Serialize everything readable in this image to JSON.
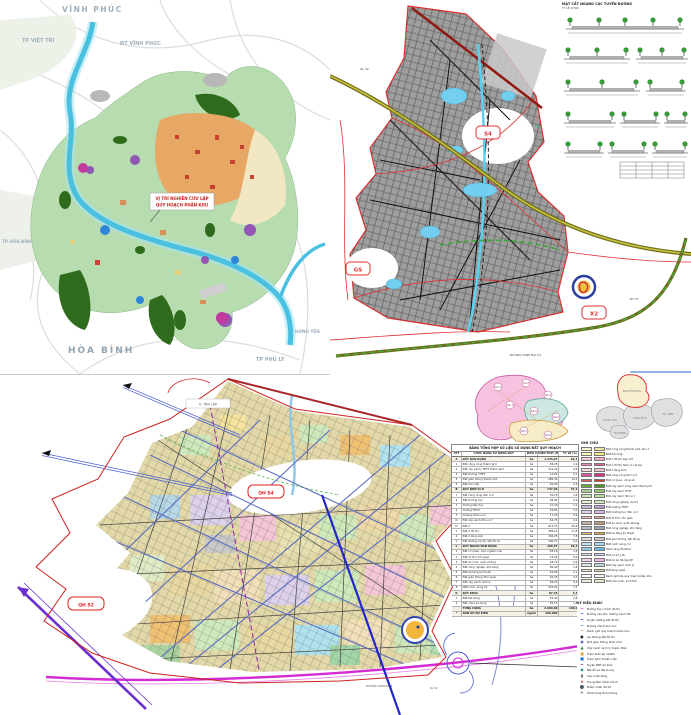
{
  "regional_map": {
    "labels": {
      "vinh_phuc": "VĨNH PHÚC",
      "dt_vinh_phuc": "ĐT VĨNH PHÚC",
      "tp_viet_tri": "TP VIỆT TRÌ",
      "tp_hoa_binh": "TP HÒA BÌNH",
      "hoa_binh": "HÒA BÌNH",
      "tp_phu_ly": "TP PHỦ LÝ",
      "hung_yen": "HƯNG YÊN"
    },
    "callout_line1": "VỊ TRÍ NGHIÊN CỨU LẬP",
    "callout_line2": "QUY HOẠCH PHÂN KHU"
  },
  "district_map": {
    "zone_labels": {
      "s4": "S4",
      "gs": "GS",
      "x2": "X2"
    },
    "road_labels": {
      "a": "QL 32",
      "b": "ĐƯỜNG VÀNH ĐAI 3,5",
      "c": "ĐT 70"
    },
    "sections_panel": {
      "title": "MẶT CẮT NGANG CÁC TUYẾN ĐƯỜNG",
      "subtitle": "TỶ LỆ 1/500"
    }
  },
  "zoning_map": {
    "zone_labels": {
      "qh_s2": "QH S2",
      "qh_s4": "QH S4"
    },
    "area_box": "X. TÂN LẬP",
    "road_labels": {
      "a": "ĐƯỜNG VÀNH ĐAI 4",
      "b": "QL 32"
    }
  },
  "panel": {
    "inset_pink_labels": [
      "S1-1",
      "S1-2",
      "S1-3",
      "S2-1",
      "S2-2",
      "S2-3",
      "S3-1",
      "S3-2"
    ],
    "inset_gray_labels": [
      "QUỐC OAI",
      "HOÀI ĐỨC",
      "TỪ LIÊM",
      "ĐAN PHƯỢNG",
      "HÀ ĐÔNG"
    ],
    "table": {
      "title": "BẢNG TỔNG HỢP SỐ LIỆU SỬ DỤNG ĐẤT QUY HOẠCH",
      "headers": [
        "STT",
        "CHỨC NĂNG SỬ DỤNG ĐẤT",
        "ĐƠN VỊ",
        "DIỆN TÍCH (HA)",
        "TỶ LỆ (%)"
      ],
      "rows": [
        [
          "A",
          "ĐẤT DÂN DỤNG",
          "ha",
          "1.245,67",
          "62,3"
        ],
        [
          "1",
          "Đất công cộng thành phố",
          "ha",
          "38,25",
          "1,9"
        ],
        [
          "2",
          "Đất cây xanh, TDTT thành phố",
          "ha",
          "112,40",
          "5,6"
        ],
        [
          "3",
          "Đất trường THPT",
          "ha",
          "14,82",
          "0,7"
        ],
        [
          "4",
          "Đất giao thông thành phố",
          "ha",
          "286,34",
          "14,3"
        ],
        [
          "5",
          "Đất hỗn hợp",
          "ha",
          "46,90",
          "2,3"
        ],
        [
          "B",
          "ĐẤT ĐƠN VỊ Ở",
          "ha",
          "747,96",
          "37,4"
        ],
        [
          "I",
          "Đất công cộng đơn vị ở",
          "ha",
          "32,15",
          "1,6"
        ],
        [
          "II",
          "Đất trường học",
          "ha",
          "58,44",
          "2,9"
        ],
        [
          "1",
          "Trường tiểu học",
          "ha",
          "21,30",
          "1,1"
        ],
        [
          "2",
          "Trường THCS",
          "ha",
          "19,85",
          "1,0"
        ],
        [
          "3",
          "Trường mầm non",
          "ha",
          "17,29",
          "0,9"
        ],
        [
          "III",
          "Đất cây xanh đơn vị ở",
          "ha",
          "44,73",
          "2,2"
        ],
        [
          "IV",
          "Đất ở",
          "ha",
          "512,37",
          "25,6"
        ],
        [
          "1",
          "Đất ở đô thị",
          "ha",
          "356,12",
          "17,8"
        ],
        [
          "2",
          "Đất ở làng xóm",
          "ha",
          "156,25",
          "7,8"
        ],
        [
          "V",
          "Đất đường nội bộ, bãi đỗ xe",
          "ha",
          "100,27",
          "5,0"
        ],
        [
          "C",
          "ĐẤT NGOÀI DÂN DỤNG",
          "ha",
          "406,37",
          "20,3"
        ],
        [
          "1",
          "Đất cơ quan, viện nghiên cứu",
          "ha",
          "28,16",
          "1,4"
        ],
        [
          "2",
          "Đất di tích, tôn giáo",
          "ha",
          "12,44",
          "0,6"
        ],
        [
          "3",
          "Đất an ninh, quốc phòng",
          "ha",
          "18,72",
          "0,9"
        ],
        [
          "4",
          "Đất công nghiệp, kho tàng",
          "ha",
          "36,90",
          "1,8"
        ],
        [
          "5",
          "Đất hạ tầng kỹ thuật",
          "ha",
          "22,58",
          "1,1"
        ],
        [
          "6",
          "Đất giao thông đối ngoại",
          "ha",
          "94,35",
          "4,7"
        ],
        [
          "7",
          "Đất cây xanh cách ly",
          "ha",
          "48,20",
          "2,4"
        ],
        [
          "8",
          "Mặt nước, sông hồ",
          "ha",
          "145,02",
          "7,3"
        ],
        [
          "D",
          "ĐẤT KHÁC",
          "ha",
          "87,45",
          "4,4"
        ],
        [
          "1",
          "Đất bãi sông",
          "ha",
          "52,30",
          "2,6"
        ],
        [
          "2",
          "Đất chưa sử dụng",
          "ha",
          "35,15",
          "1,8"
        ],
        [
          "",
          "TỔNG CỘNG",
          "ha",
          "2.000,00",
          "100,0"
        ],
        [
          "*",
          "DÂN SỐ DỰ KIẾN",
          "người",
          "160.000",
          ""
        ]
      ]
    },
    "legend": {
      "title": "GHI CHÚ",
      "items": [
        {
          "c1": "#f5eecb",
          "c2": "#efe3a6",
          "label": "Đất công cộng thành phố, khu ở"
        },
        {
          "c1": "#fdf3b0",
          "c2": "#f9e97e",
          "label": "Đất hỗn hợp"
        },
        {
          "c1": "#f8cadd",
          "c2": "#f3aacb",
          "label": "Đất ở đô thị xây mới"
        },
        {
          "c1": "#f086b8",
          "c2": "#e55f9f",
          "label": "Đất ở đô thị hiện có cải tạo"
        },
        {
          "c1": "#f6dade",
          "c2": "#f0c4cc",
          "label": "Đất ở làng xóm"
        },
        {
          "c1": "#e0559f",
          "c2": "#d63384",
          "label": "Đất công cộng đơn vị ở"
        },
        {
          "c1": "#dd5a50",
          "c2": "#cb3a30",
          "label": "Đất cơ quan, công sở"
        },
        {
          "c1": "#6aab3c",
          "c2": "#55942c",
          "label": "Đất cây xanh công viên thành phố"
        },
        {
          "c1": "#a9d18e",
          "c2": "#92c272",
          "label": "Đất cây xanh TDTT"
        },
        {
          "c1": "#cbe8ba",
          "c2": "#b6dda2",
          "label": "Đất cây xanh đơn vị ở"
        },
        {
          "c1": "#e1f0d1",
          "c2": "#d2e8bf",
          "label": "Đất nông nghiệp, dự trữ"
        },
        {
          "c1": "#cdb5dd",
          "c2": "#bb9ad0",
          "label": "Đất trường THPT"
        },
        {
          "c1": "#e3cfee",
          "c2": "#d5b8e6",
          "label": "Đất trường học đơn vị ở"
        },
        {
          "c1": "#f1bab4",
          "c2": "#e9a098",
          "label": "Đất di tích, tôn giáo"
        },
        {
          "c1": "#c8b39a",
          "c2": "#b69d80",
          "label": "Đất an ninh, quốc phòng"
        },
        {
          "c1": "#b7bec7",
          "c2": "#9ca5b1",
          "label": "Đất công nghiệp, kho tàng"
        },
        {
          "c1": "#ecc05a",
          "c2": "#e2ad38",
          "label": "Đất hạ tầng kỹ thuật"
        },
        {
          "c1": "#dddddd",
          "c2": "#c6c6c6",
          "label": "Đất giao thông, bãi đỗ xe"
        },
        {
          "c1": "#c2e5f6",
          "c2": "#a2d7f1",
          "label": "Mặt nước sông, hồ"
        },
        {
          "c1": "#90cbe7",
          "c2": "#6dbade",
          "label": "Hành lang thoát lũ"
        },
        {
          "c1": "#e7e1f9",
          "c2": "#d6cef3",
          "label": "Đất cơ sở y tế"
        },
        {
          "c1": "#f4d2f5",
          "c2": "#ebb5ed",
          "label": "Đất dự án đã lập QH"
        },
        {
          "c1": "#d1e9e5",
          "c2": "#b7ddd6",
          "label": "Đất cây xanh cách ly"
        },
        {
          "c1": "#f3e0c2",
          "c2": "#ecd0a2",
          "label": "Đất làng nghề"
        },
        {
          "c1": "#ffffff",
          "c2": "#f2f2f2",
          "label": "Ranh giới lập quy hoạch phân khu"
        },
        {
          "c1": "#e9f3dc",
          "c2": "#dcedc8",
          "label": "Đất nhà vườn, sinh thái"
        }
      ]
    },
    "symbols": {
      "title": "KÝ HIỆU KHÁC",
      "items": [
        {
          "color": "#d42bd4",
          "glyph": "━",
          "label": "Đường trục chính đô thị"
        },
        {
          "color": "#6a2fd0",
          "glyph": "━",
          "label": "Đường cao tốc, đường vành đai"
        },
        {
          "color": "#2326c8",
          "glyph": "━",
          "label": "Tuyến đường sắt đô thị"
        },
        {
          "color": "#5b6cc0",
          "glyph": "━",
          "label": "Đường chính khu vực"
        },
        {
          "color": "#cc2222",
          "glyph": "╌",
          "label": "Ranh giới quy hoạch phân khu"
        },
        {
          "color": "#333333",
          "glyph": "●",
          "label": "Ga đường sắt đô thị"
        },
        {
          "color": "#3346b2",
          "glyph": "◉",
          "label": "Nút giao thông khác mức"
        },
        {
          "color": "#2e7d32",
          "glyph": "▲",
          "label": "Cây xanh cách ly tuyến điện"
        },
        {
          "color": "#e8a23c",
          "glyph": "■",
          "label": "Trạm biến áp 110KV"
        },
        {
          "color": "#1976d2",
          "glyph": "■",
          "label": "Trạm bơm thoát nước"
        },
        {
          "color": "#8e24aa",
          "glyph": "━",
          "label": "Tuyến BRT dự kiến"
        },
        {
          "color": "#00897b",
          "glyph": "◆",
          "label": "Bãi đỗ xe tập trung"
        },
        {
          "color": "#5d4037",
          "glyph": "▮",
          "label": "Cầu vượt sông"
        },
        {
          "color": "#c62828",
          "glyph": "★",
          "label": "Trung tâm hành chính"
        },
        {
          "color": "#455a64",
          "glyph": "⬤",
          "label": "Điểm nhấn đô thị"
        },
        {
          "color": "#444444",
          "glyph": "✈",
          "label": "Hành lang tĩnh không"
        }
      ]
    }
  }
}
